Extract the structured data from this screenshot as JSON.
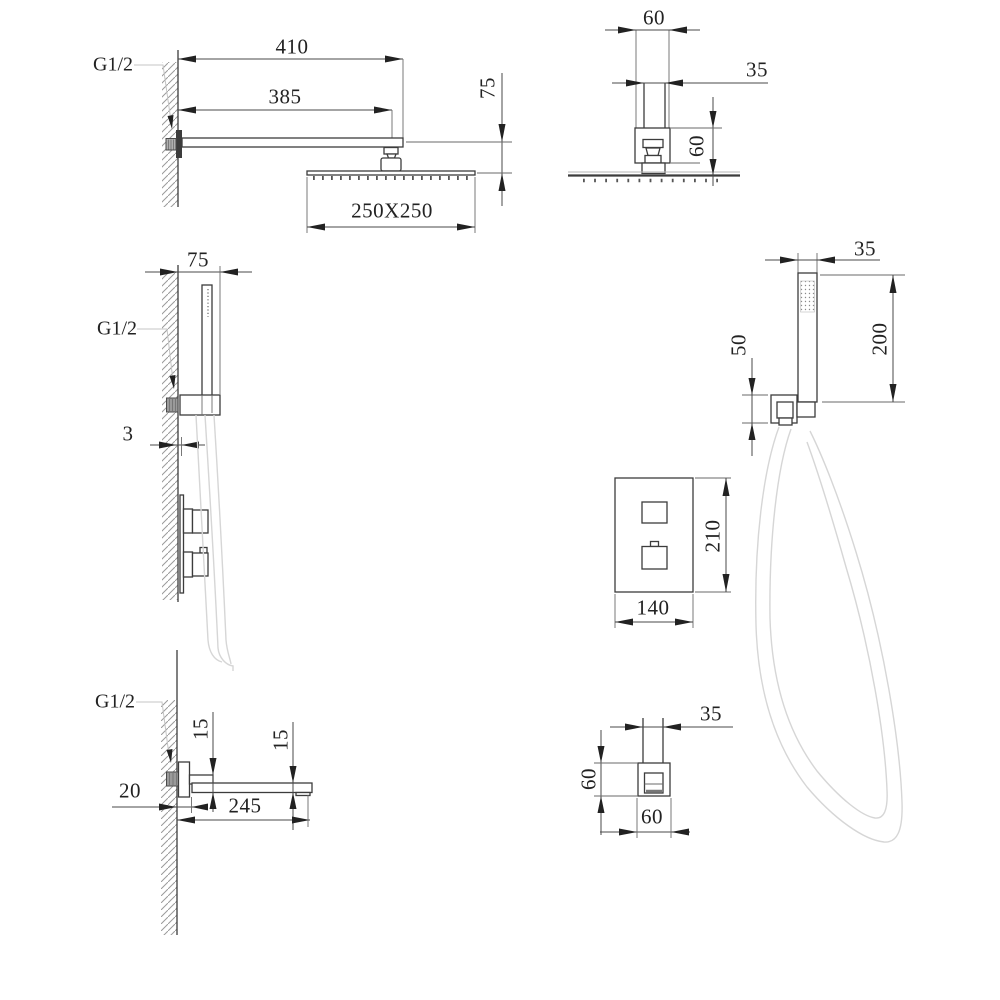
{
  "colors": {
    "ink": "#3c3c3c",
    "light_line": "#c4c4c4",
    "hose_line": "#d6d6d6"
  },
  "views": {
    "shower_head_side": {
      "thread": "G1/2",
      "dim_arm_length": "410",
      "dim_arm_reach": "385",
      "dim_head_drop": "75",
      "dim_head_size": "250X250"
    },
    "shower_head_front": {
      "dim_escutcheon_width": "60",
      "dim_arm_width": "35",
      "dim_escutcheon_height": "60"
    },
    "hand_shower_side": {
      "dim_bracket_depth": "75",
      "thread": "G1/2",
      "dim_plate_gap": "3"
    },
    "hand_shower_front": {
      "dim_handle_width": "35",
      "dim_handle_length": "200",
      "dim_outlet_height": "50"
    },
    "mixer_valve_front": {
      "dim_plate_height": "210",
      "dim_plate_width": "140"
    },
    "spout_side": {
      "thread": "G1/2",
      "dim_thickness_near": "15",
      "dim_thickness_tip": "15",
      "dim_wall_offset": "20",
      "dim_length": "245"
    },
    "spout_front": {
      "dim_tube_width": "35",
      "dim_body_height": "60",
      "dim_body_width": "60"
    }
  }
}
